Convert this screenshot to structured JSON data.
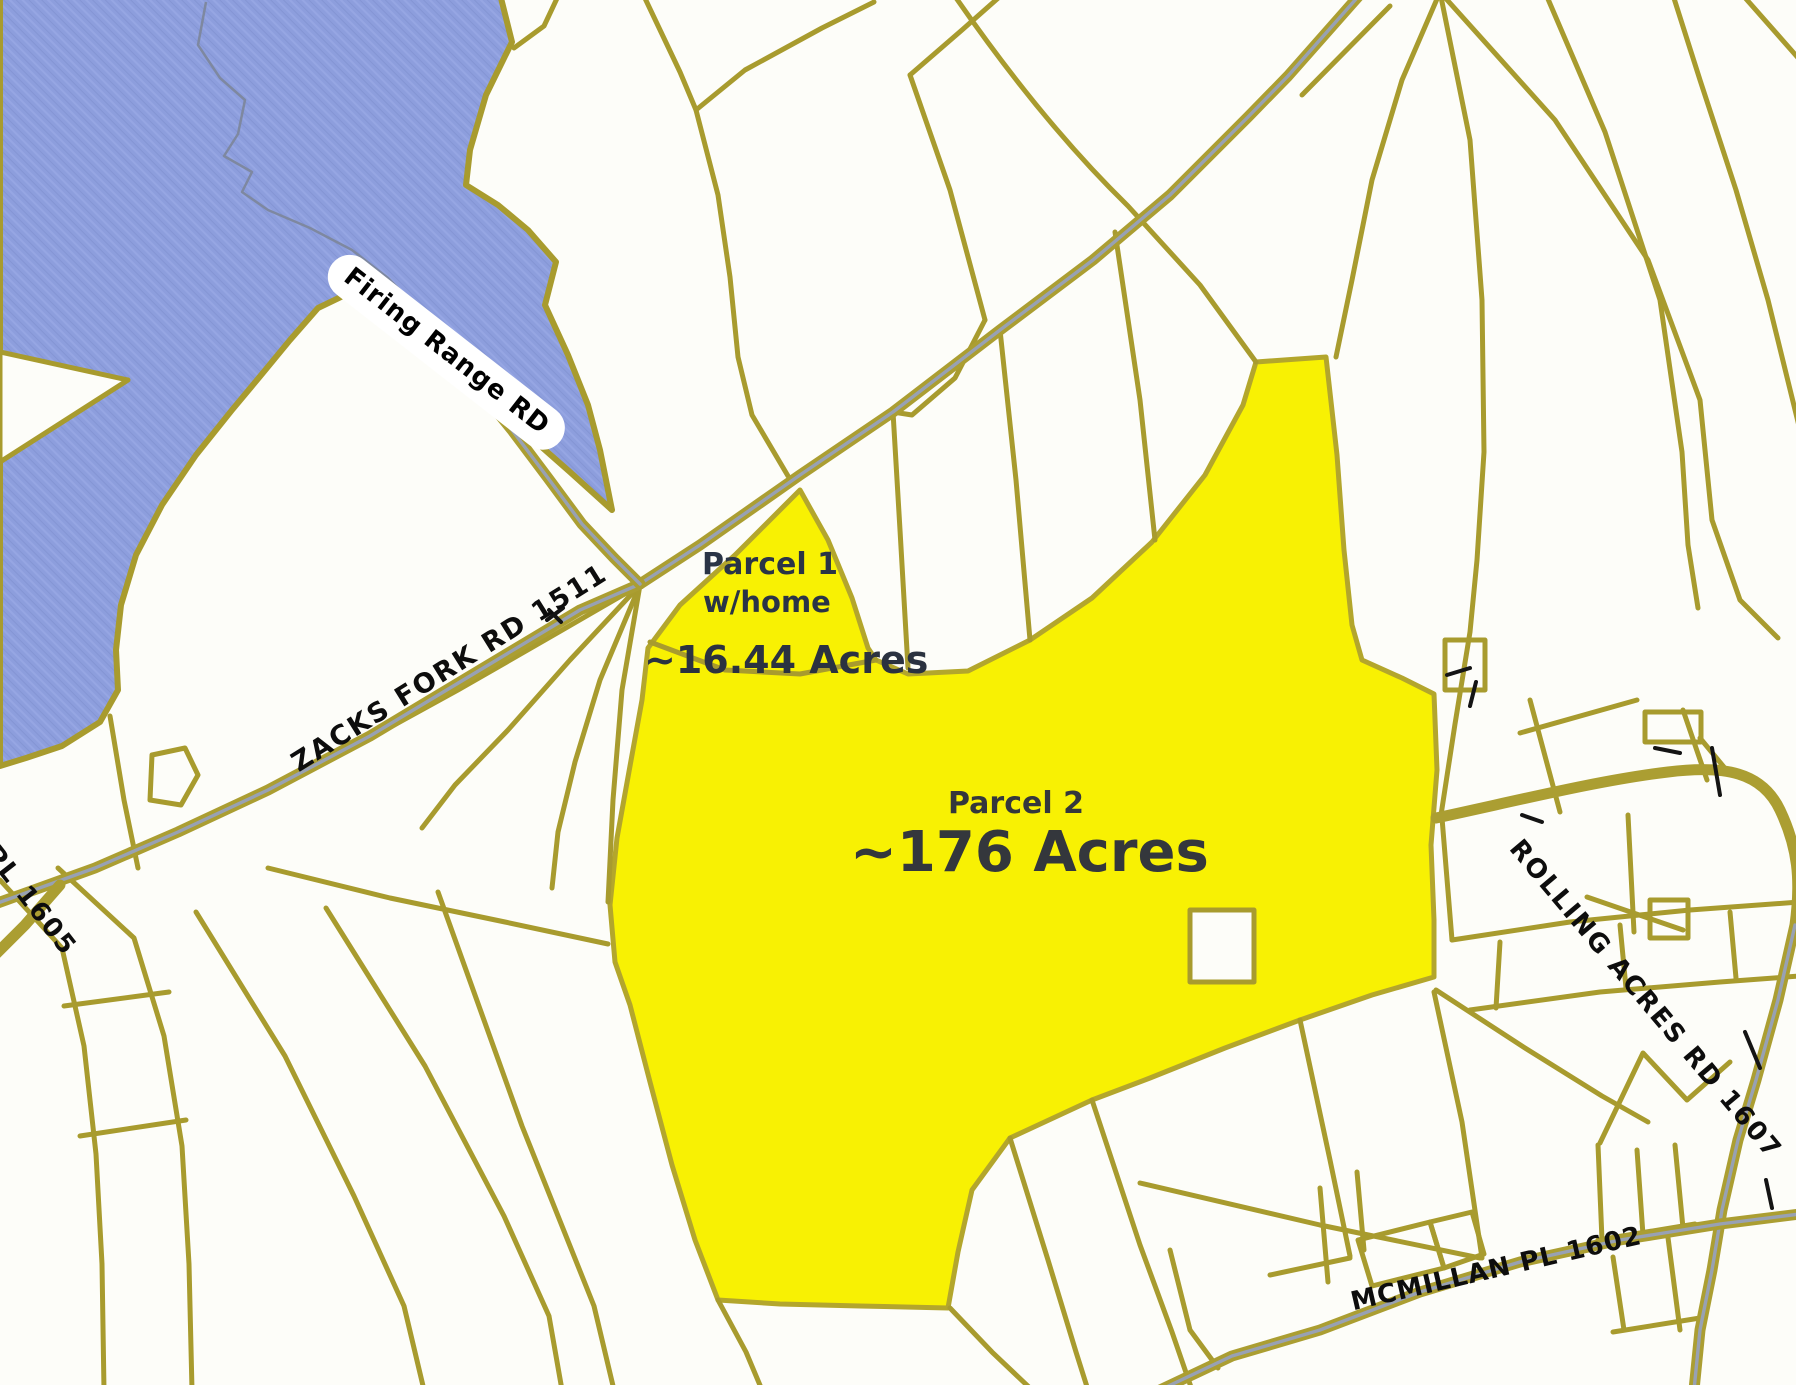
{
  "map_type": "scanned parcel plat map",
  "colors": {
    "background": "#fdfdf9",
    "water": "#8d9edd",
    "boundary_line": "#a89b2e",
    "road_centerline": "#98a1b3",
    "parcel_highlight": "#f8f103",
    "road_label_text": "#0d0d0d",
    "parcel_label_text": "#2a3446"
  },
  "road_labels": {
    "firing_range": "Firing Range RD",
    "zacks_fork": "ZACKS FORK RD 1511",
    "pl": "PL 1605",
    "rolling_acres": "ROLLING ACRES RD 1607",
    "mcmillan": "MCMILLAN PL 1602"
  },
  "parcels": [
    {
      "name": "Parcel 1",
      "note": "w/home",
      "acreage": "~16.44 Acres"
    },
    {
      "name": "Parcel 2",
      "acreage": "~176 Acres"
    }
  ]
}
